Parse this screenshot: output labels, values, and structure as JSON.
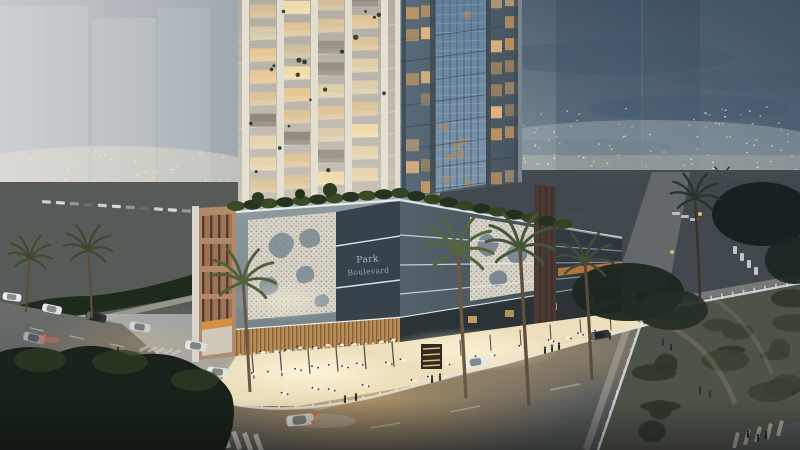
{
  "scene": {
    "kind": "architectural-dusk-render"
  },
  "building_sign": {
    "line1": "Park",
    "line2": "Boulevard"
  },
  "colors": {
    "sky_left": "#a9aeb2",
    "sky_mid": "#8d99a3",
    "sky_right": "#4f6378",
    "cloud": "#3f5569",
    "horizon_glow": "#ded6c2",
    "city_light_warm": "#ffd98f",
    "city_light_cool": "#cfe4ff",
    "tower_left_face": "#c9c3b8",
    "tower_mullion": "#e8e2d5",
    "window_glow": "#e7c993",
    "tower_right_face": "#5a6b79",
    "glass_shaft": "#7e95a9",
    "podium_face": "#8d9a9e",
    "podium_dark_band": "#37424b",
    "led_strip": "#f2f7f7",
    "perforated_panel": "#d8d3c6",
    "mosaic_splotch": "#6e7e8c",
    "terracotta": "#b08a6a",
    "pilaster_wood": "#4a3a33",
    "wood_band": "#b98d58",
    "terrace_light": "#eddfbb",
    "road_warm": "#a8885c",
    "road_dark": "#5f6263",
    "foliage_dark": "#1d2a1c",
    "palm_frond": "#4c5c33",
    "fence_light": "#cfd3d5",
    "sign_text": "#b9c2c9"
  }
}
